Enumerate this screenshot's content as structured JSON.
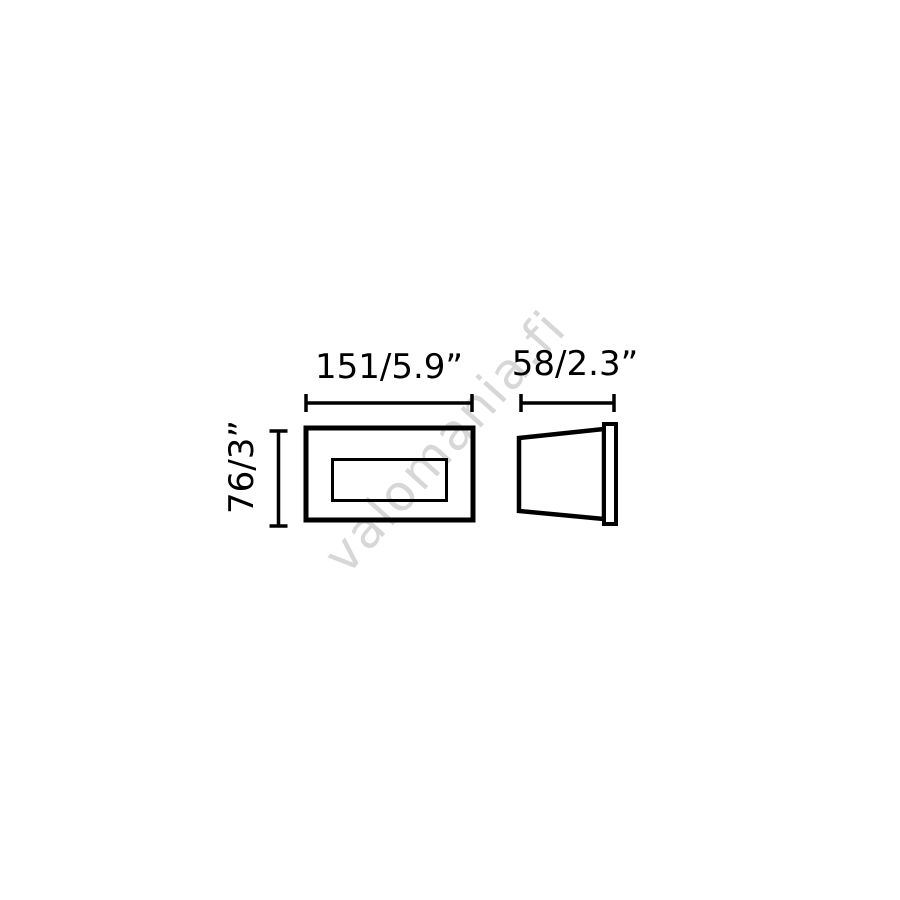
{
  "watermark": {
    "text": "valomania.fi",
    "color": "#d7d7d7"
  },
  "drawing": {
    "type": "technical-dimension-diagram",
    "views": [
      "front-view",
      "side-profile-view"
    ],
    "line_color": "#000000",
    "background_color": "#ffffff"
  },
  "dimensions": {
    "width": {
      "label": "151/5.9”",
      "millimeters": 151,
      "inches": 5.9
    },
    "depth": {
      "label": "58/2.3”",
      "millimeters": 58,
      "inches": 2.3
    },
    "height": {
      "label": "76/3”",
      "millimeters": 76,
      "inches": 3
    }
  }
}
